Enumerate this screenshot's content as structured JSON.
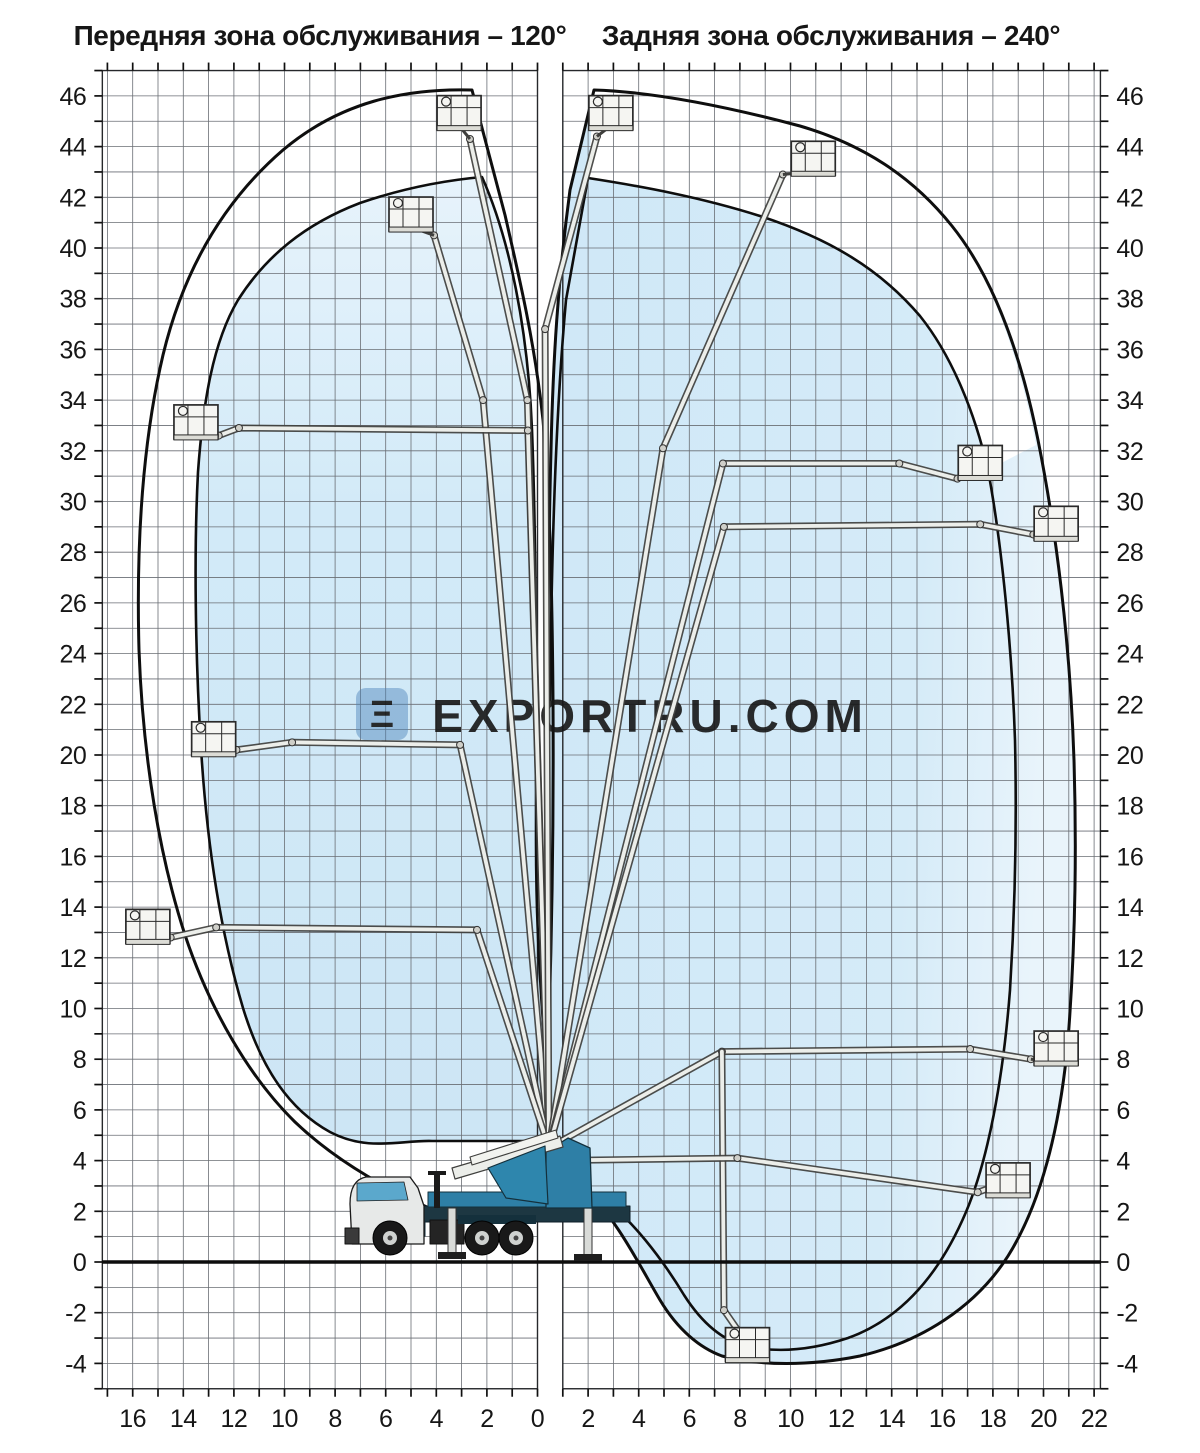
{
  "page": {
    "width": 1200,
    "height": 1453,
    "background": "#ffffff"
  },
  "header": {
    "front_zone_title": "Передняя зона обслуживания – 120°",
    "rear_zone_title": "Задняя зона обслуживания – 240°"
  },
  "watermark": {
    "text": "EXPORTRU.COM",
    "logo_glyph": "Ξ"
  },
  "colors": {
    "envelope_fill": "#cfe8f7",
    "envelope_fill_light": "#e9f4fb",
    "outline": "#0e0e0e",
    "grid_line": "#6a6e74",
    "axis_text": "#161616",
    "truck_blue": "#2e7fa6",
    "truck_dark": "#17323f",
    "boom_fill": "#eceeea",
    "boom_stroke": "#3f3f3d",
    "watermark_gray": "rgba(122,135,148,0.55)",
    "watermark_logo_blue": "rgba(74,130,184,0.5)"
  },
  "axes": {
    "y_labels": [
      46,
      44,
      42,
      40,
      38,
      36,
      34,
      32,
      30,
      28,
      26,
      24,
      22,
      20,
      18,
      16,
      14,
      12,
      10,
      8,
      6,
      4,
      2,
      0,
      -2,
      -4
    ],
    "x_labels_front": [
      16,
      14,
      12,
      10,
      8,
      6,
      4,
      2,
      0
    ],
    "x_labels_rear": [
      2,
      4,
      6,
      8,
      10,
      12,
      14,
      16,
      18,
      20,
      22
    ]
  },
  "chart_data": {
    "type": "diagram",
    "units": "m",
    "grid": {
      "y_range": [
        -5,
        47
      ],
      "x_front_range": [
        -17.2,
        0
      ],
      "x_rear_range": [
        1,
        22.25
      ],
      "step": 1,
      "label_step": 2
    },
    "front_zone": {
      "angle_label": "120°",
      "max_height_m": 46,
      "max_outreach_m": 16.5,
      "basket_positions_m": [
        [
          3.1,
          45.3
        ],
        [
          5.0,
          41.3
        ],
        [
          13.5,
          33.1
        ],
        [
          12.8,
          20.6
        ],
        [
          15.4,
          13.2
        ]
      ]
    },
    "rear_zone": {
      "angle_label": "240°",
      "max_height_m": 46,
      "max_outreach_m": 21.5,
      "max_depth_m": -4,
      "basket_positions_m": [
        [
          2.9,
          45.3
        ],
        [
          10.9,
          43.5
        ],
        [
          17.5,
          31.5
        ],
        [
          20.5,
          29.1
        ],
        [
          20.5,
          8.4
        ],
        [
          18.6,
          3.2
        ],
        [
          8.3,
          -3.3
        ]
      ]
    },
    "booms": [
      {
        "name": "boom-front-vertical",
        "pts": [
          [
            0.45,
            4.5
          ],
          [
            -0.4,
            34.0
          ],
          [
            -2.67,
            44.3
          ]
        ],
        "basket": [
          -3.1,
          45.3
        ]
      },
      {
        "name": "boom-front-41m",
        "pts": [
          [
            0.45,
            4.5
          ],
          [
            -2.15,
            34.0
          ],
          [
            -4.09,
            40.5
          ]
        ],
        "basket": [
          -5.0,
          41.3
        ]
      },
      {
        "name": "boom-front-33m",
        "pts": [
          [
            0.45,
            4.5
          ],
          [
            -0.38,
            32.8
          ],
          [
            -11.8,
            32.9
          ],
          [
            -12.6,
            32.6
          ]
        ],
        "basket": [
          -13.5,
          33.1
        ]
      },
      {
        "name": "boom-front-20m",
        "pts": [
          [
            0.45,
            4.5
          ],
          [
            -3.06,
            20.4
          ],
          [
            -9.7,
            20.5
          ],
          [
            -11.9,
            20.2
          ]
        ],
        "basket": [
          -12.8,
          20.6
        ]
      },
      {
        "name": "boom-front-13m",
        "pts": [
          [
            0.45,
            4.5
          ],
          [
            -2.39,
            13.1
          ],
          [
            -12.7,
            13.2
          ],
          [
            -14.5,
            12.8
          ]
        ],
        "basket": [
          -15.4,
          13.2
        ]
      },
      {
        "name": "boom-rear-vertical",
        "pts": [
          [
            0.45,
            4.5
          ],
          [
            0.3,
            36.8
          ],
          [
            2.35,
            44.4
          ]
        ],
        "basket": [
          2.9,
          45.3
        ]
      },
      {
        "name": "boom-rear-43m",
        "pts": [
          [
            0.45,
            4.5
          ],
          [
            4.96,
            32.1
          ],
          [
            9.7,
            42.9
          ]
        ],
        "basket": [
          10.9,
          43.5
        ]
      },
      {
        "name": "boom-rear-31m",
        "pts": [
          [
            0.45,
            4.5
          ],
          [
            7.33,
            31.5
          ],
          [
            14.3,
            31.5
          ],
          [
            16.6,
            30.9
          ]
        ],
        "basket": [
          17.5,
          31.5
        ]
      },
      {
        "name": "boom-rear-29m",
        "pts": [
          [
            0.45,
            4.5
          ],
          [
            7.37,
            29.0
          ],
          [
            17.5,
            29.1
          ],
          [
            19.6,
            28.7
          ]
        ],
        "basket": [
          20.5,
          29.1
        ]
      },
      {
        "name": "boom-rear-8m",
        "pts": [
          [
            0.45,
            4.5
          ],
          [
            7.29,
            8.3
          ],
          [
            17.1,
            8.4
          ],
          [
            19.5,
            8.0
          ]
        ],
        "basket": [
          20.5,
          8.4
        ]
      },
      {
        "name": "boom-rear-underground",
        "pts": [
          [
            7.29,
            8.3
          ],
          [
            7.37,
            -1.9
          ],
          [
            7.97,
            -2.76
          ]
        ],
        "basket": [
          8.3,
          -3.3
        ]
      },
      {
        "name": "boom-rear-3m",
        "pts": [
          [
            0.45,
            4.0
          ],
          [
            7.9,
            4.1
          ],
          [
            17.4,
            2.75
          ],
          [
            18.1,
            3.0
          ]
        ],
        "basket": [
          18.6,
          3.2
        ]
      }
    ]
  }
}
